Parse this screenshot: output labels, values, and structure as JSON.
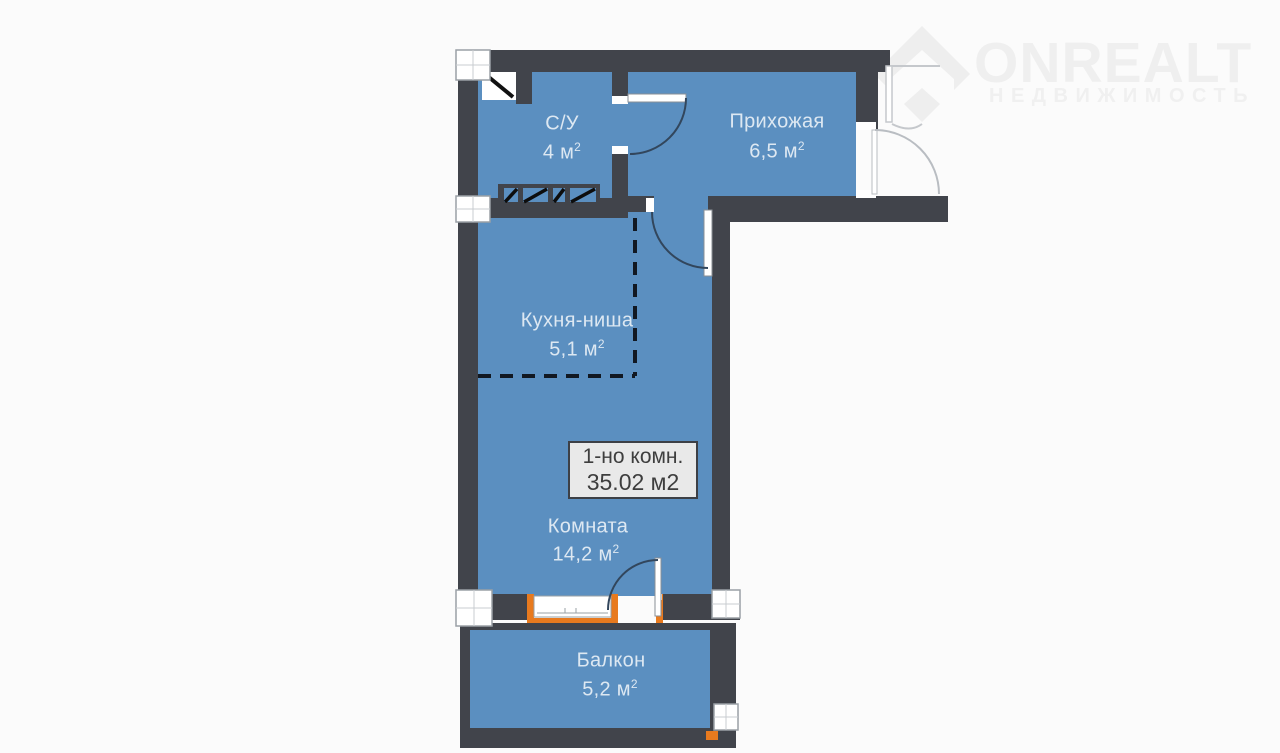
{
  "logo": {
    "brand": "ONREALT",
    "tagline": "НЕДВИЖИМОСТЬ",
    "color": "#efefef"
  },
  "plan": {
    "summary": {
      "line1": "1-но комн.",
      "line2": "35.02 м2"
    },
    "rooms": [
      {
        "id": "bathroom",
        "name": "С/У",
        "area": "4 м",
        "sup": "2"
      },
      {
        "id": "hallway",
        "name": "Прихожая",
        "area": "6,5 м",
        "sup": "2"
      },
      {
        "id": "kitchen-niche",
        "name": "Кухня-ниша",
        "area": "5,1 м",
        "sup": "2"
      },
      {
        "id": "living-room",
        "name": "Комната",
        "area": "14,2 м",
        "sup": "2"
      },
      {
        "id": "balcony",
        "name": "Балкон",
        "area": "5,2 м",
        "sup": "2"
      }
    ],
    "colors": {
      "wall": "#41444b",
      "floor": "#5b8fc0",
      "accent_orange": "#e87a1e",
      "label_box_bg": "#e9e9e9",
      "label_box_text": "#3e3e3e",
      "room_text": "#dde8f2"
    }
  }
}
